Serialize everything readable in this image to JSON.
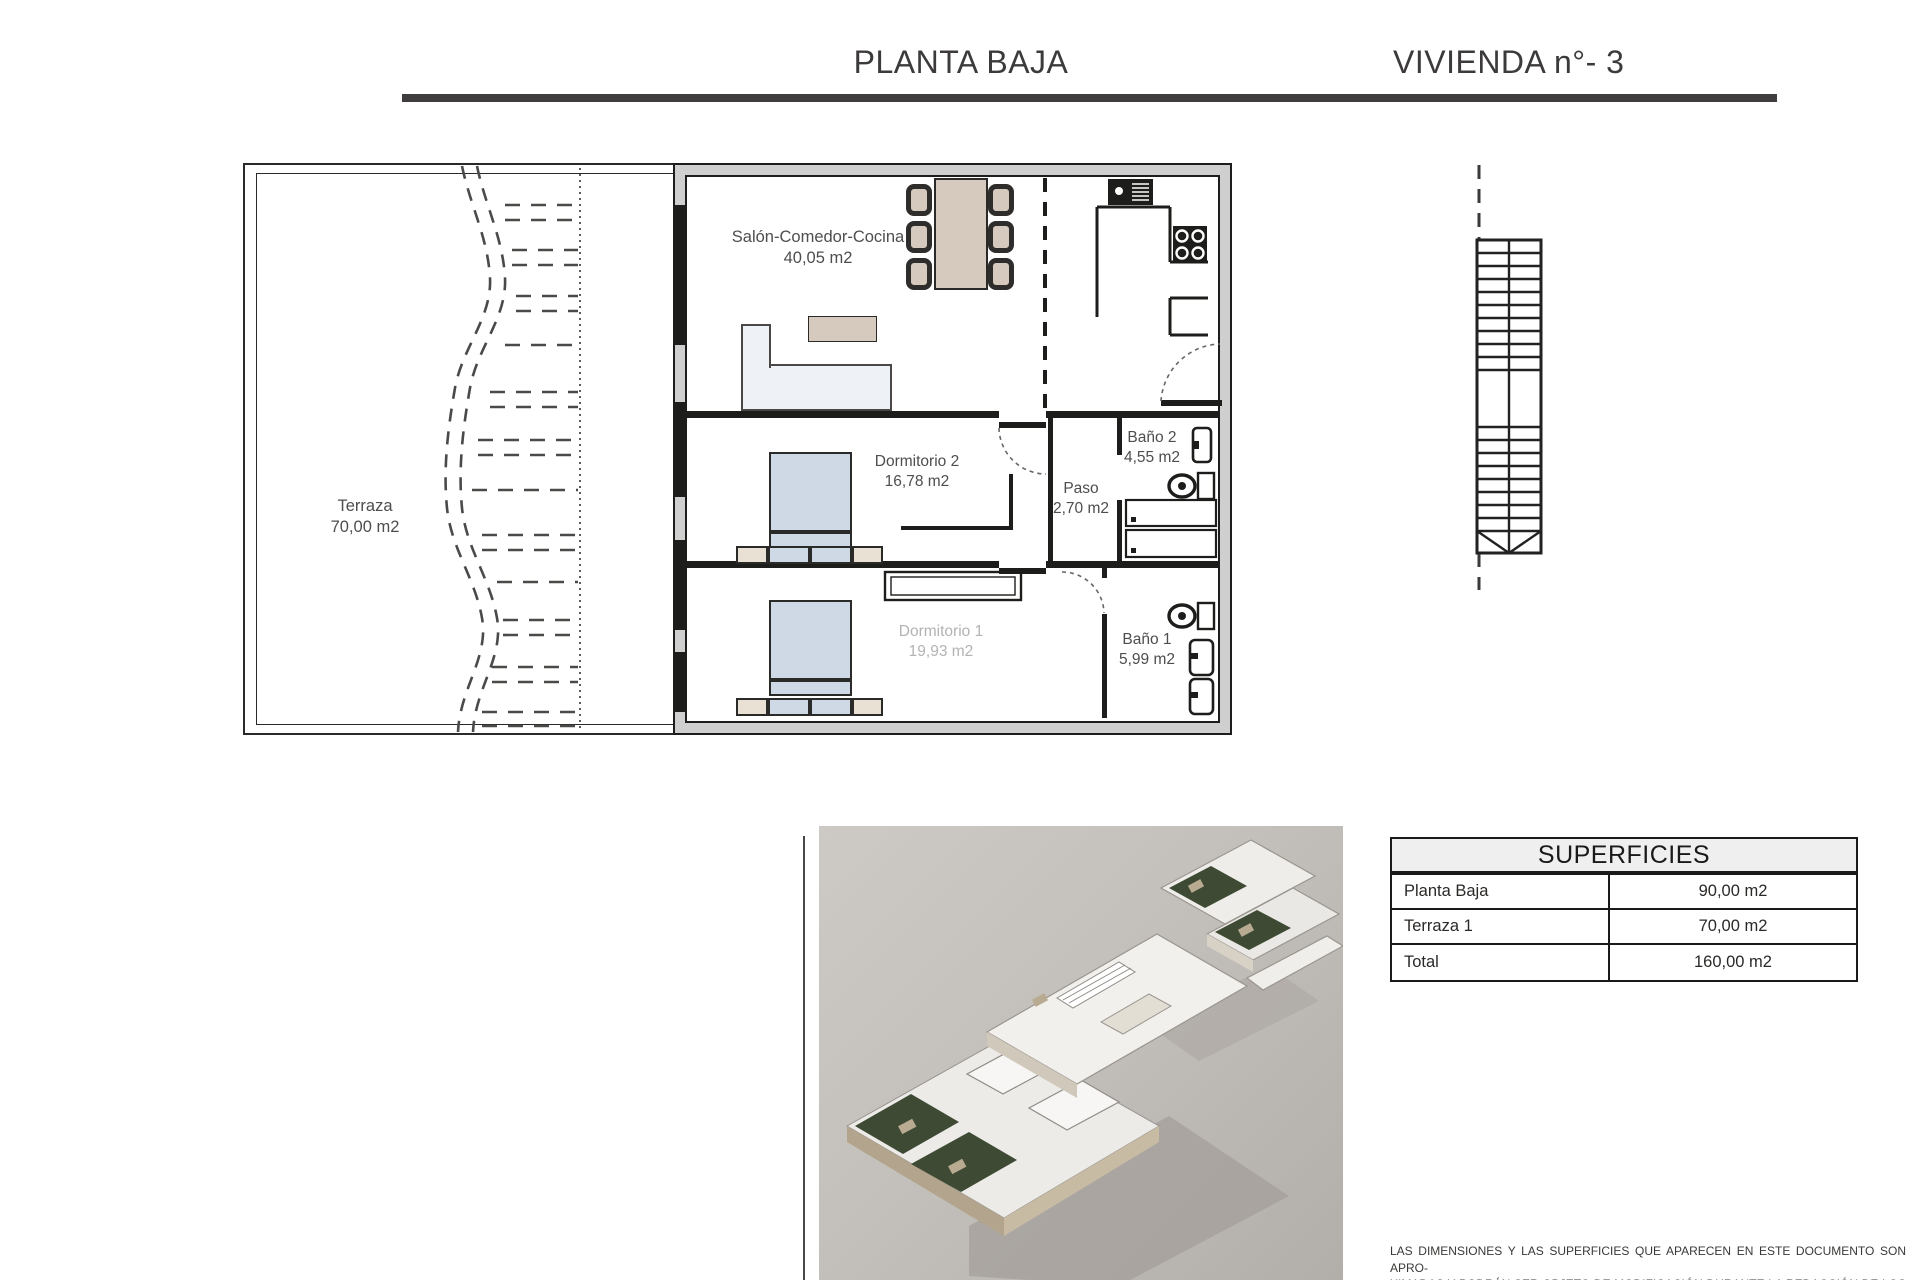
{
  "header": {
    "title_left": "PLANTA BAJA",
    "title_right": "VIVIENDA n°- 3"
  },
  "plan": {
    "terraza": {
      "name": "Terraza",
      "area": "70,00 m2"
    },
    "salon": {
      "name": "Salón-Comedor-Cocina",
      "area": "40,05 m2"
    },
    "dormitorio2": {
      "name": "Dormitorio 2",
      "area": "16,78 m2"
    },
    "paso": {
      "name": "Paso",
      "area": "2,70 m2"
    },
    "bano2": {
      "name": "Baño 2",
      "area": "4,55 m2"
    },
    "dormitorio1": {
      "name": "Dormitorio 1",
      "area": "19,93 m2"
    },
    "bano1": {
      "name": "Baño 1",
      "area": "5,99 m2"
    }
  },
  "superficies": {
    "title": "SUPERFICIES",
    "rows": [
      {
        "label": "Planta Baja",
        "value": "90,00 m2"
      },
      {
        "label": "Terraza 1",
        "value": "70,00 m2"
      },
      {
        "label": "Total",
        "value": "160,00 m2"
      }
    ]
  },
  "disclaimer": {
    "lines": [
      "LAS DIMENSIONES Y LAS SUPERFICIES QUE APARECEN EN ESTE DOCUMENTO SON APRO-",
      "XIMADAS Y PODRÁN SER OBJETO DE MODIFICACIÓN DURANTE LA REDACCIÓN DE LOS",
      "PROYECTOS BÁSICO Y DE EJECUCIÓN"
    ]
  },
  "colors": {
    "accent_dark": "#3f3d3e",
    "wall": "#1d1d1b",
    "wall_fill": "#cfcfcf",
    "bed_blue": "#cfd9e6",
    "wood_tan": "#d5cabd",
    "header_bg": "#efefef",
    "render_bg": "#c5c1bd",
    "faint_label": "#b5b3b1"
  }
}
